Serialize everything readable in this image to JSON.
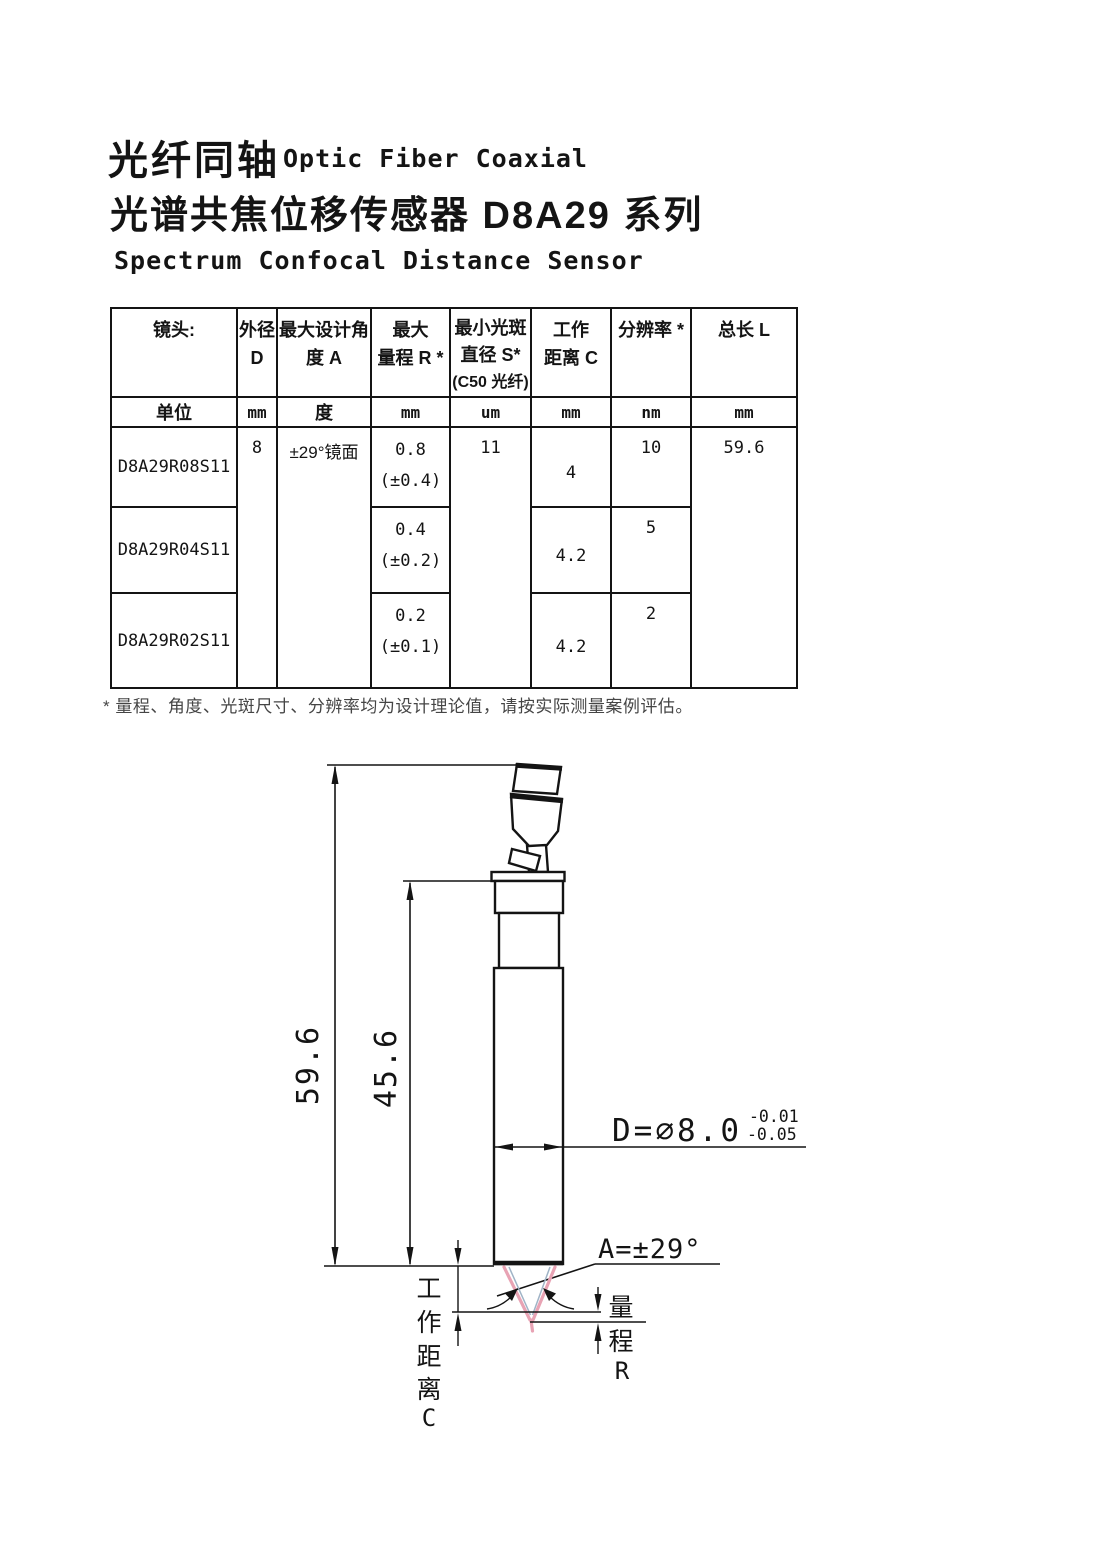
{
  "title": {
    "zh1": "光纤同轴",
    "en1": "Optic Fiber Coaxial",
    "zh2": "光谱共焦位移传感器 D8A29 系列",
    "en2": "Spectrum Confocal Distance Sensor"
  },
  "table": {
    "header": {
      "lens": "镜头:",
      "d1": "外径",
      "d2": "D",
      "a1": "最大设计角",
      "a2": "度 A",
      "r1": "最大",
      "r2": "量程 R *",
      "s1": "最小光斑",
      "s2": "直径 S*",
      "s3": "(C50 光纤)",
      "c1": "工作",
      "c2": "距离 C",
      "res": "分辨率 *",
      "l": "总长 L"
    },
    "units": {
      "label": "单位",
      "d": "mm",
      "a": "度",
      "r": "mm",
      "s": "um",
      "c": "mm",
      "res": "nm",
      "l": "mm"
    },
    "shared": {
      "outer_diameter": "8",
      "design_angle": "±29°镜面",
      "spot_diameter": "11",
      "total_length": "59.6"
    },
    "rows": [
      {
        "model": "D8A29R08S11",
        "range": "0.8",
        "range_tol": "(±0.4)",
        "working_distance": "4",
        "resolution": "10"
      },
      {
        "model": "D8A29R04S11",
        "range": "0.4",
        "range_tol": "(±0.2)",
        "working_distance": "4.2",
        "resolution": "5"
      },
      {
        "model": "D8A29R02S11",
        "range": "0.2",
        "range_tol": "(±0.1)",
        "working_distance": "4.2",
        "resolution": "2"
      }
    ]
  },
  "footnote": "* 量程、角度、光斑尺寸、分辨率均为设计理论值，请按实际测量案例评估。",
  "drawing": {
    "dim_total_length": "59.6",
    "dim_body_length": "45.6",
    "diameter_label": "D=∅8.0",
    "tolerance_upper": "-0.01",
    "tolerance_lower": "-0.05",
    "angle_label": "A=±29°",
    "working_distance_label": [
      "工",
      "作",
      "距",
      "离",
      "C"
    ],
    "range_label": [
      "量",
      "程",
      "R"
    ]
  },
  "colors": {
    "cone_pink": "#e8a3b4",
    "cone_inner": "#9fb3c6",
    "line": "#141414"
  }
}
